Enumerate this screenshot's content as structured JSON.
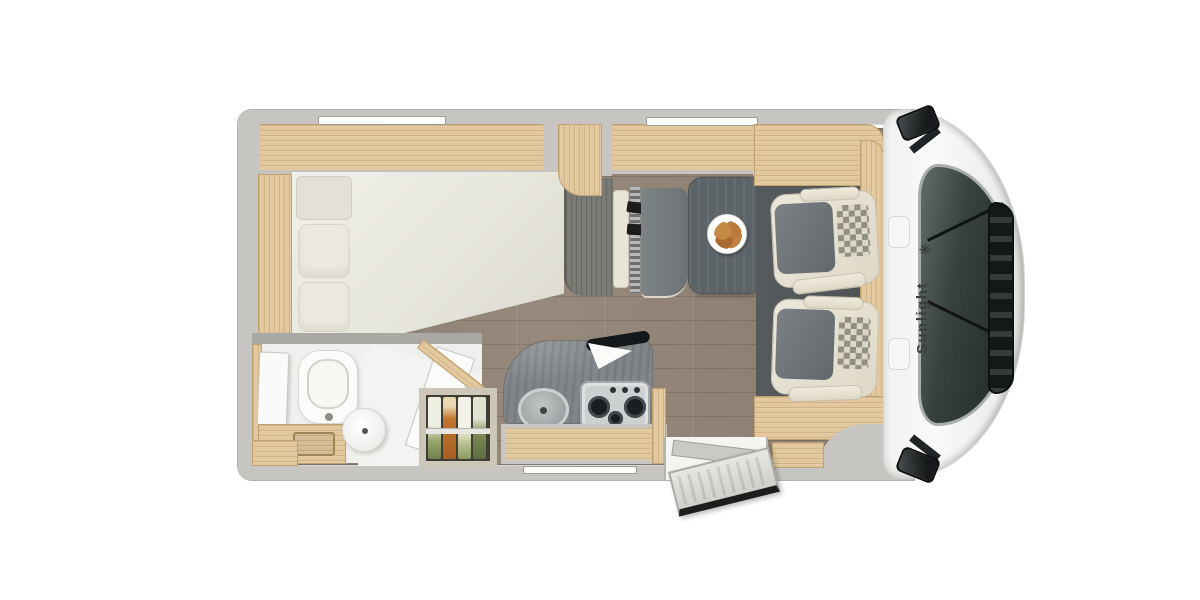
{
  "brand": {
    "label": "Sunlight",
    "symbol": "✳"
  },
  "scene": {
    "type": "motorhome-floorplan-top-view",
    "areas": [
      "rear-bedroom",
      "bathroom",
      "pantry",
      "kitchen",
      "dinette",
      "cab",
      "entry-door"
    ]
  },
  "colors": {
    "wall": "#c6c5c2",
    "wallLine": "#a9a8a5",
    "wood": "#e2c79d",
    "woodEdge": "#c2a171",
    "floor": "#8e8175",
    "cabFloor": "#4d5254",
    "counter": "#82868a",
    "table": "#5d6468",
    "bench": "#767b7d",
    "cream": "#e9e5d6",
    "seatGray": "#6f7478",
    "checker": "#8f8c80",
    "mattress": "#edece4",
    "windshield": "#37413d",
    "dark": "#181b1c",
    "brandText": "#3b3e41",
    "carrot": "#c0762f",
    "leek": "#7c8a56",
    "plateFood": "#b97c3f"
  }
}
